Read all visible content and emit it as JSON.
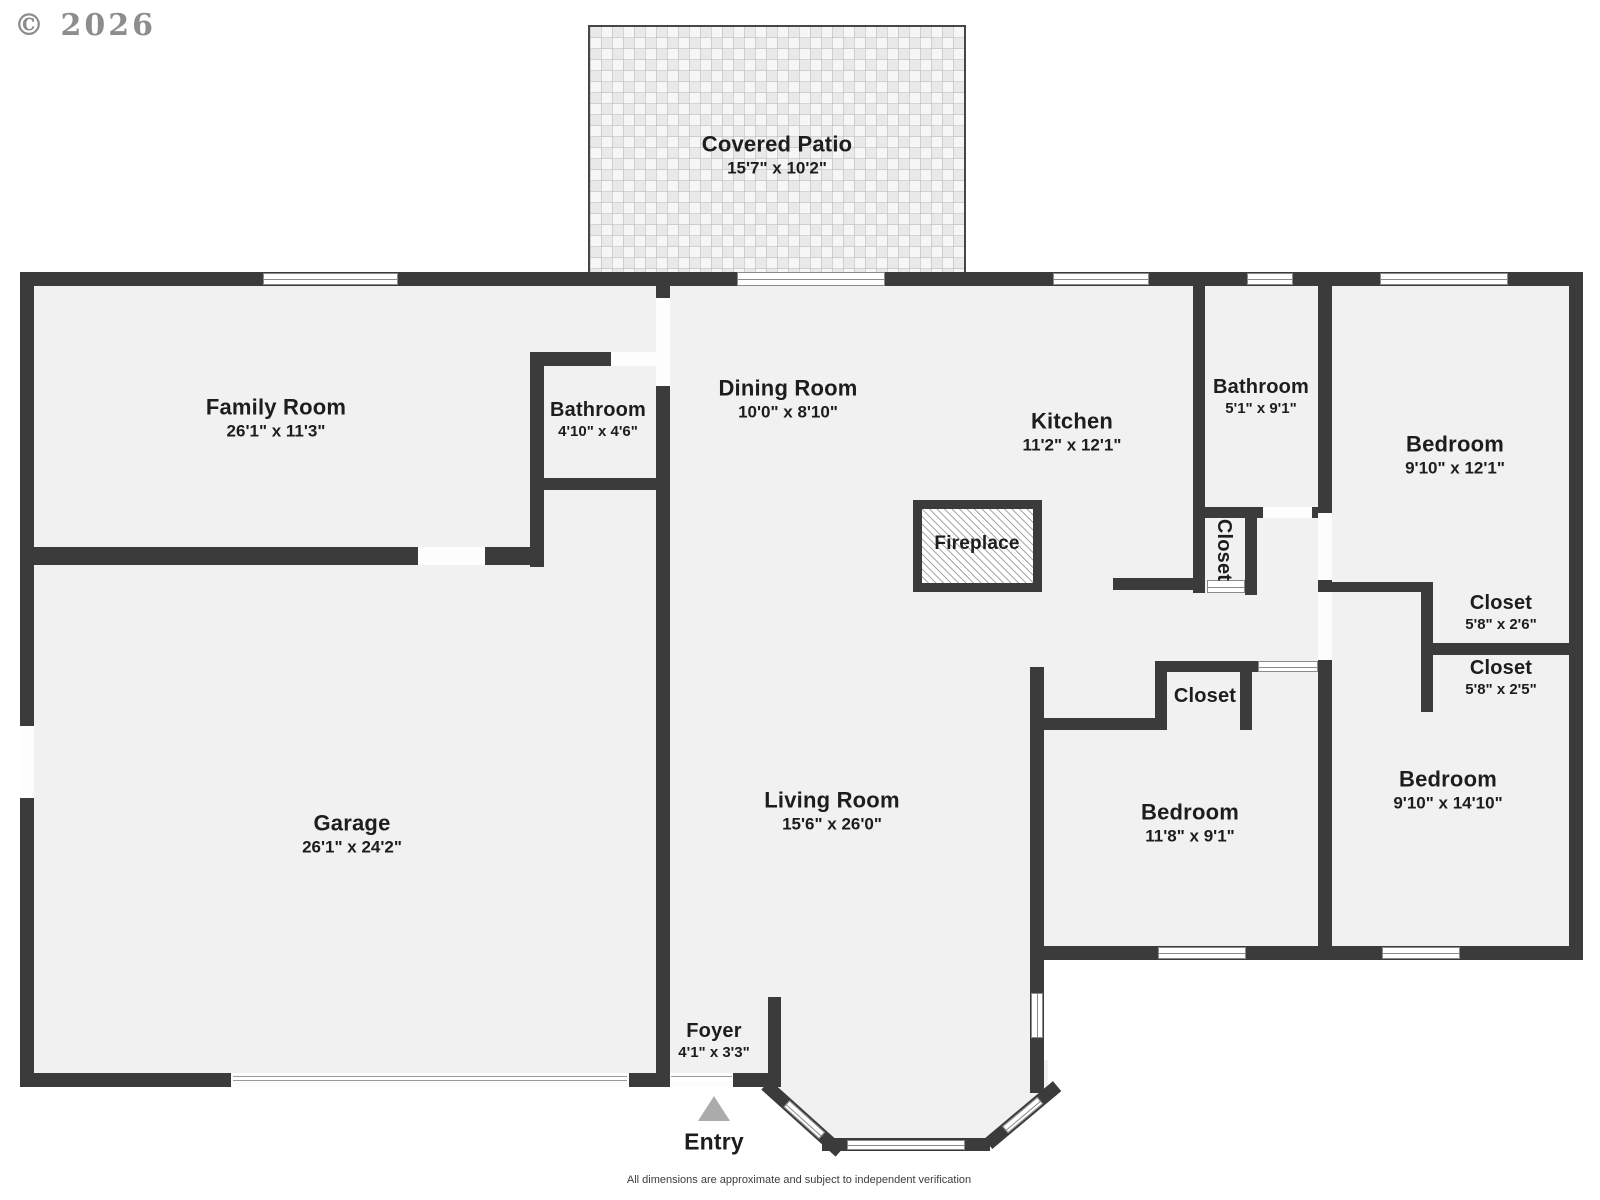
{
  "meta": {
    "copyright": "© 2026",
    "disclaimer": "All dimensions are approximate and subject to independent verification"
  },
  "entry": {
    "label": "Entry"
  },
  "rooms": {
    "covered_patio": {
      "name": "Covered Patio",
      "dims": "15'7\" x 10'2\""
    },
    "family_room": {
      "name": "Family Room",
      "dims": "26'1\" x 11'3\""
    },
    "bathroom_family": {
      "name": "Bathroom",
      "dims": "4'10\" x 4'6\""
    },
    "dining_room": {
      "name": "Dining Room",
      "dims": "10'0\" x 8'10\""
    },
    "kitchen": {
      "name": "Kitchen",
      "dims": "11'2\" x 12'1\""
    },
    "fireplace": {
      "name": "Fireplace"
    },
    "bathroom_hall": {
      "name": "Bathroom",
      "dims": "5'1\" x 9'1\""
    },
    "closet_hall": {
      "name": "Closet"
    },
    "bedroom_top_right": {
      "name": "Bedroom",
      "dims": "9'10\" x 12'1\""
    },
    "closet_upper": {
      "name": "Closet",
      "dims": "5'8\" x 2'6\""
    },
    "closet_lower": {
      "name": "Closet",
      "dims": "5'8\" x 2'5\""
    },
    "garage": {
      "name": "Garage",
      "dims": "26'1\" x 24'2\""
    },
    "living_room": {
      "name": "Living Room",
      "dims": "15'6\" x 26'0\""
    },
    "closet_bedroom": {
      "name": "Closet"
    },
    "bedroom_middle": {
      "name": "Bedroom",
      "dims": "11'8\" x 9'1\""
    },
    "bedroom_bottom_right": {
      "name": "Bedroom",
      "dims": "9'10\" x 14'10\""
    },
    "foyer": {
      "name": "Foyer",
      "dims": "4'1\" x 3'3\""
    }
  },
  "colors": {
    "wall": "#3b3b3b",
    "floor": "#f1f1f2",
    "entry_arrow": "#ababab"
  }
}
